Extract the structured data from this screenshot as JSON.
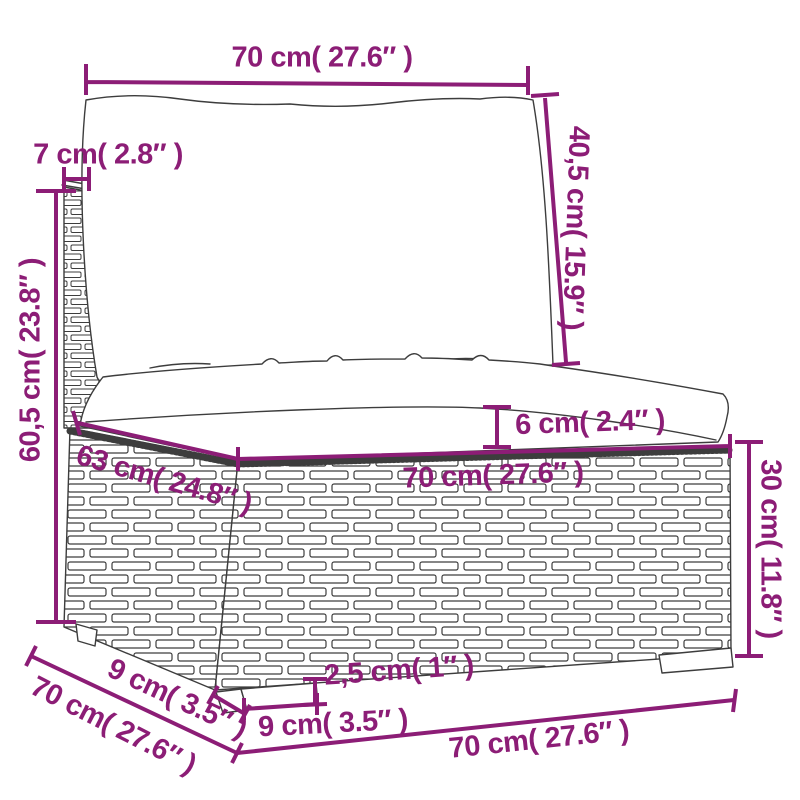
{
  "diagram": {
    "subject": "poly-rattan sofa middle section with cushions - dimension drawing",
    "accent_color": "#8c1d76",
    "outline_color": "#3d3d3d",
    "dimensions": {
      "top_width": "70 cm( 27.6″ )",
      "back_rail_depth": "7 cm( 2.8″ )",
      "back_cushion_height": "40,5 cm( 15.9″ )",
      "total_height": "60,5 cm( 23.8″ )",
      "cushion_thickness": "6 cm( 2.4″ )",
      "seat_depth": "63 cm( 24.8″ )",
      "seat_width": "70 cm( 27.6″ )",
      "base_height": "30 cm( 11.8″ )",
      "foot_height": "2,5 cm( 1″ )",
      "foot_width": "9 cm( 3.5″ )",
      "foot_depth": "9 cm( 3.5″ )",
      "overall_depth": "70 cm( 27.6″ )",
      "overall_width": "70 cm( 27.6″ )"
    }
  }
}
